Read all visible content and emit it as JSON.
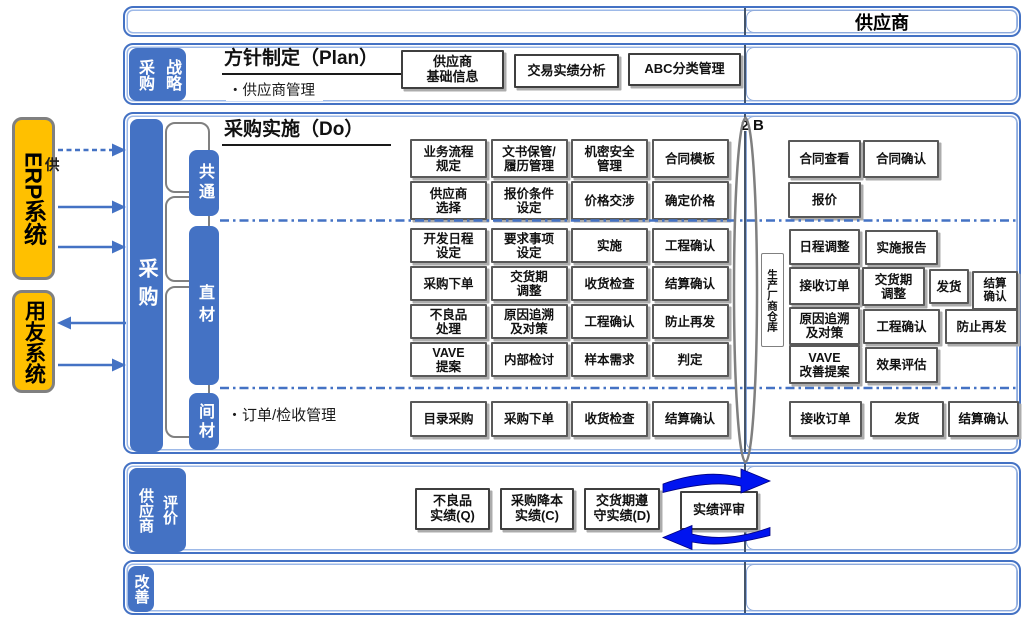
{
  "colors": {
    "accent_blue": "#4472C4",
    "light_blue_border": "#8EAADB",
    "bright_arrow_blue": "#0014F0",
    "system_box_orange": "#FFC000",
    "box_border_gray": "#595959",
    "ellipse_gray": "#7F7F7F"
  },
  "left_systems": {
    "erp": "ERP系统",
    "yonyou": "用友系统",
    "partial_label": "供"
  },
  "top_bar": {
    "supplier_title": "供应商"
  },
  "marker": {
    "prefix": "2",
    "label": "B"
  },
  "strategy": {
    "label_left": "采购",
    "label_right": "战略",
    "heading": "方针制定（Plan）",
    "subheading": "・供应商管理",
    "boxes": [
      "供应商\n基础信息",
      "交易实绩分析",
      "ABC分类管理"
    ]
  },
  "procurement": {
    "bar_label": "采购",
    "heading": "采购实施（Do）",
    "common": {
      "label": "共通",
      "rows": [
        [
          "业务流程\n规定",
          "文书保管/\n履历管理",
          "机密安全\n管理",
          "合同模板"
        ],
        [
          "供应商\n选择",
          "报价条件\n设定",
          "价格交涉",
          "确定价格"
        ]
      ]
    },
    "direct": {
      "label": "直材",
      "rows": [
        [
          "开发日程\n设定",
          "要求事项\n设定",
          "实施",
          "工程确认"
        ],
        [
          "采购下单",
          "交货期\n调整",
          "收货检查",
          "结算确认"
        ],
        [
          "不良品\n处理",
          "原因追溯\n及对策",
          "工程确认",
          "防止再发"
        ],
        [
          "VAVE\n提案",
          "内部检讨",
          "样本需求",
          "判定"
        ]
      ]
    },
    "indirect": {
      "label": "间材",
      "note": "・订单/检收管理",
      "row": [
        "目录采购",
        "采购下单",
        "收货检查",
        "结算确认"
      ]
    },
    "warehouse": "生产厂商仓库"
  },
  "supplier_column": {
    "common": [
      "合同查看",
      "合同确认",
      "报价"
    ],
    "direct": [
      [
        "日程调整",
        "实施报告"
      ],
      [
        "接收订单",
        "交货期\n调整",
        "发货",
        "结算\n确认"
      ],
      [
        "原因追溯\n及对策",
        "工程确认",
        "防止再发"
      ],
      [
        "VAVE\n改善提案",
        "效果评估"
      ]
    ],
    "indirect": [
      "接收订单",
      "发货",
      "结算确认"
    ]
  },
  "evaluation": {
    "label_left": "供应商",
    "label_right": "评价",
    "boxes": [
      "不良品\n实绩(Q)",
      "采购降本\n实绩(C)",
      "交货期遵\n守实绩(D)"
    ],
    "review": "实绩评审"
  },
  "improvement": {
    "label": "改善"
  }
}
